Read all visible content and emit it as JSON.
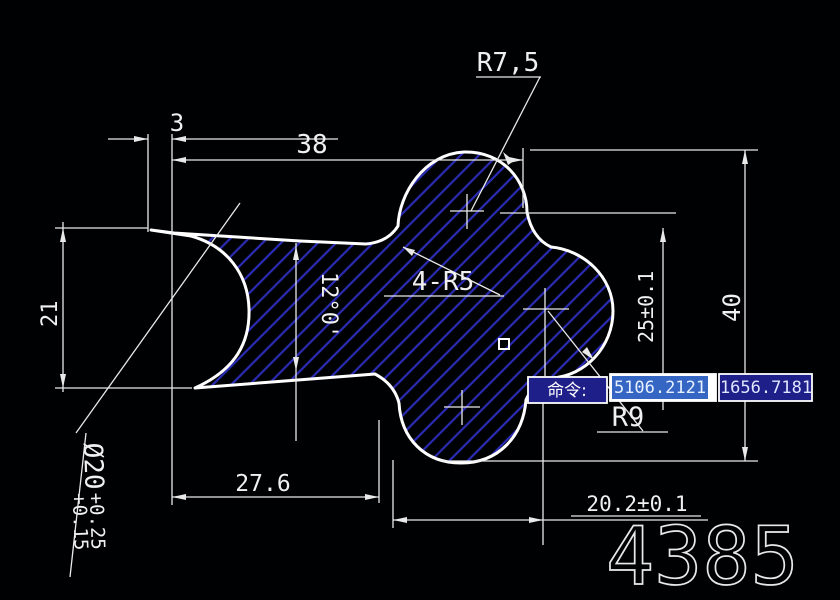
{
  "drawing": {
    "radius_top_label": "R7,5",
    "width_38": "38",
    "width_3": "3",
    "height_21": "21",
    "angle_taper": "12°0'",
    "fillet_note": "4-R5",
    "height_25": "25±0.1",
    "height_40": "40",
    "radius_right_label": "R9",
    "width_276": "27.6",
    "width_202": "20.2±0.1",
    "bore_diameter": "Ø20",
    "bore_tol_upper": "+0.25",
    "bore_tol_lower": "+0.15",
    "part_number": "4385"
  },
  "command_bar": {
    "prompt": "命令:",
    "coord_x": "5106.2121",
    "coord_y": "1656.7181"
  },
  "colors": {
    "background": "#000103",
    "outline": "#ffffff",
    "hatch_blue": "#2b2bb4",
    "dimension": "#e9e9e9",
    "box_fill_navy": "#1f1f8a",
    "box_border": "#ffffff",
    "selection_blue": "#3566c4",
    "field_text": "#e8f2ff"
  }
}
